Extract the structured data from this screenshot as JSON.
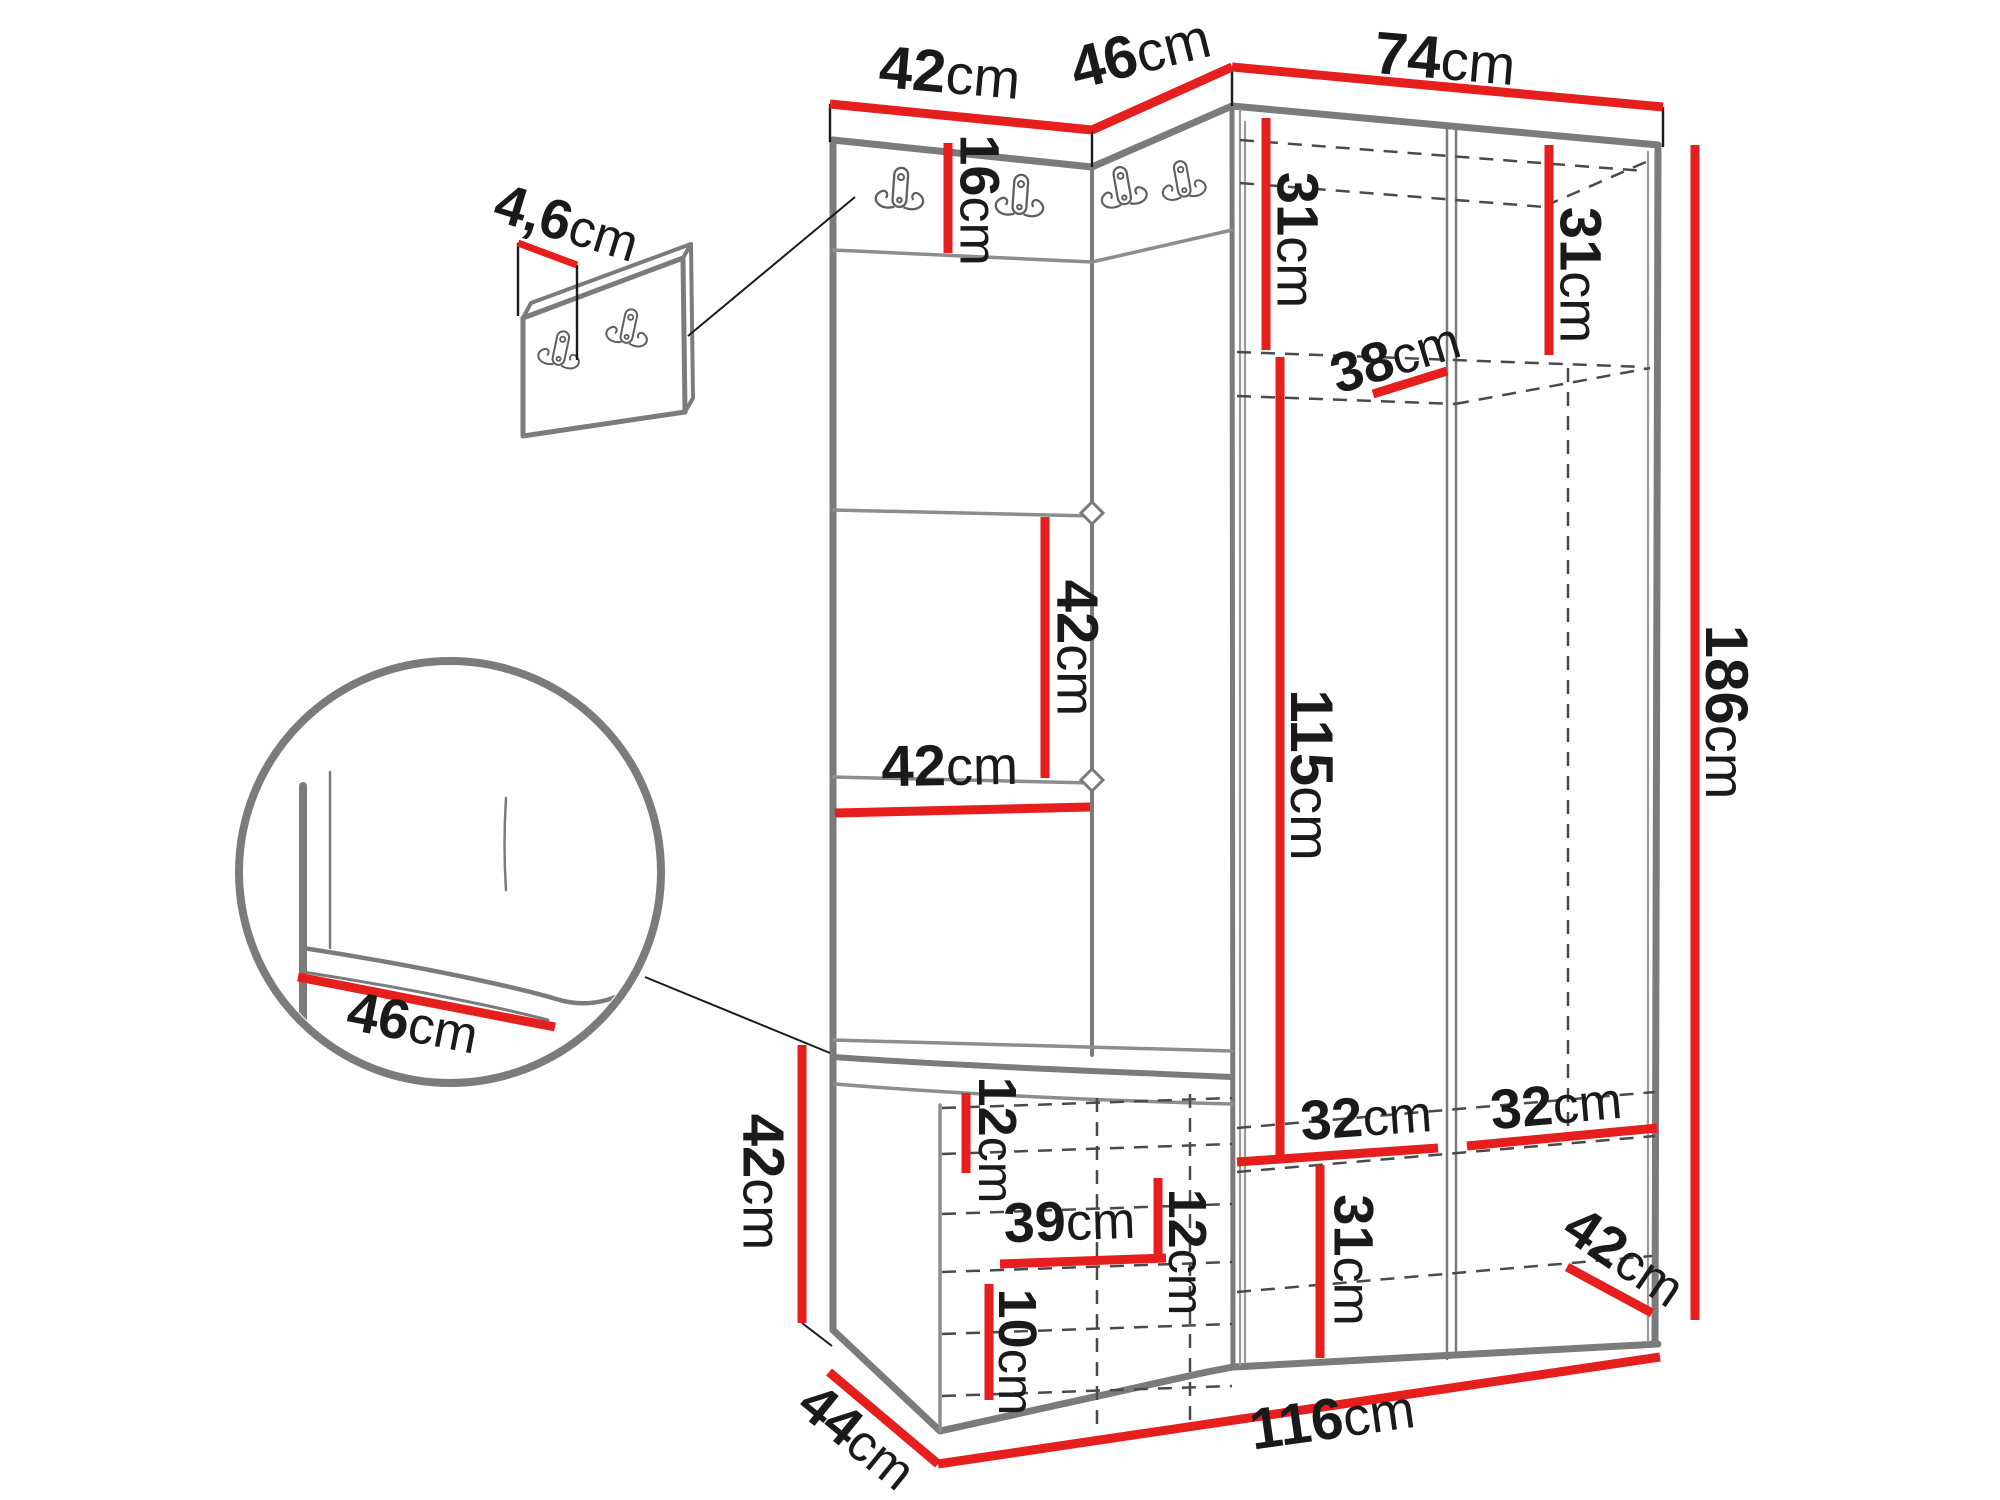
{
  "diagram": {
    "kind": "hallway furniture set dimension drawing",
    "unit": "cm",
    "colors": {
      "dimension_line": "#e61e1e",
      "outline": "#7b7b7b",
      "hidden_line": "#4a4a4a",
      "label_text": "#1a1a1a",
      "background": "#ffffff"
    },
    "dimensions": {
      "top_left_width": {
        "value": "42",
        "unit": "cm"
      },
      "top_corner_width": {
        "value": "46",
        "unit": "cm"
      },
      "top_right_width": {
        "value": "74",
        "unit": "cm"
      },
      "panel_thickness": {
        "value": "4,6",
        "unit": "cm"
      },
      "hook_row_height": {
        "value": "16",
        "unit": "cm"
      },
      "wardrobe_top_left_height": {
        "value": "31",
        "unit": "cm"
      },
      "wardrobe_top_right_height": {
        "value": "31",
        "unit": "cm"
      },
      "top_shelf_depth": {
        "value": "38",
        "unit": "cm"
      },
      "panel_section_height": {
        "value": "42",
        "unit": "cm"
      },
      "panel_width": {
        "value": "42",
        "unit": "cm"
      },
      "wardrobe_middle_height": {
        "value": "115",
        "unit": "cm"
      },
      "total_height": {
        "value": "186",
        "unit": "cm"
      },
      "seat_depth_detail": {
        "value": "46",
        "unit": "cm"
      },
      "bench_height": {
        "value": "42",
        "unit": "cm"
      },
      "bench_top_clearance": {
        "value": "12",
        "unit": "cm"
      },
      "bench_interior_width": {
        "value": "39",
        "unit": "cm"
      },
      "bench_middle_clearance": {
        "value": "12",
        "unit": "cm"
      },
      "bench_bottom_clearance": {
        "value": "10",
        "unit": "cm"
      },
      "bottom_section_height": {
        "value": "31",
        "unit": "cm"
      },
      "bottom_shelf_left_width": {
        "value": "32",
        "unit": "cm"
      },
      "bottom_shelf_right_width": {
        "value": "32",
        "unit": "cm"
      },
      "bottom_right_depth": {
        "value": "42",
        "unit": "cm"
      },
      "bench_depth": {
        "value": "44",
        "unit": "cm"
      },
      "total_width": {
        "value": "116",
        "unit": "cm"
      }
    }
  }
}
